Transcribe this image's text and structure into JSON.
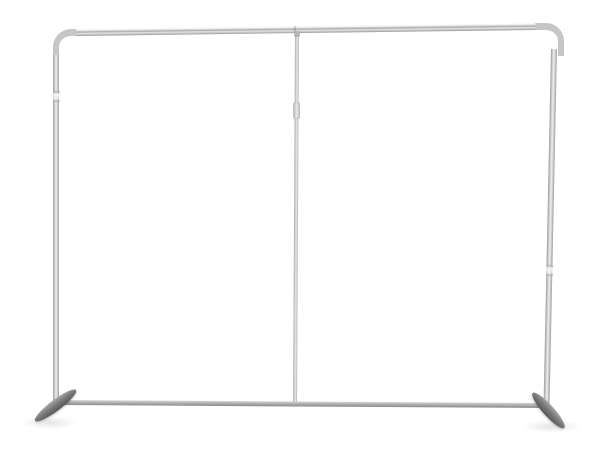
{
  "scene": {
    "background_color": "#ffffff",
    "colors": {
      "tube_highlight": "#efefef",
      "tube_mid": "#c6c6c6",
      "tube_edge": "#9a9a9a",
      "foot_light": "#a6a6a6",
      "foot_dark": "#565656"
    },
    "parts": [
      "frame-top-bar",
      "frame-corner-top-left",
      "frame-corner-top-right",
      "frame-left-upright",
      "frame-right-upright",
      "frame-center-pole",
      "frame-bottom-bar",
      "frame-left-foot",
      "frame-right-foot"
    ]
  }
}
